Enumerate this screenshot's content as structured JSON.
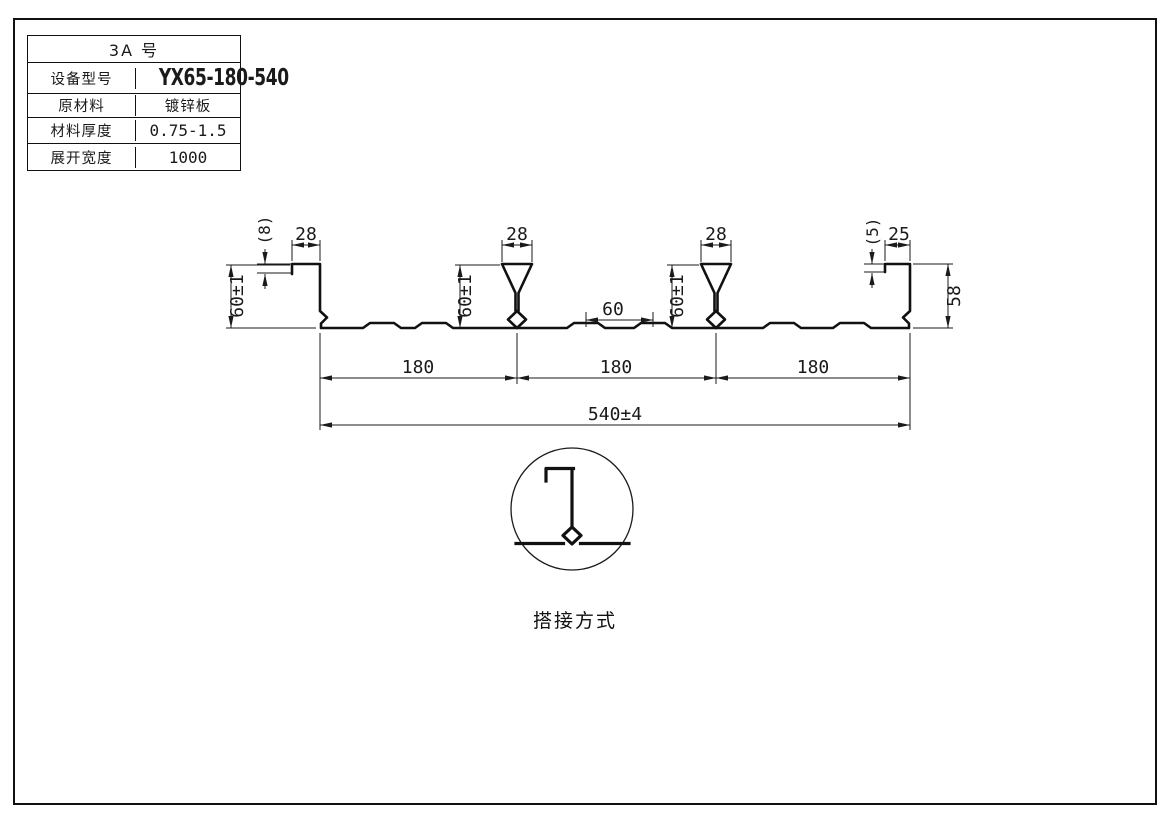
{
  "spec_table": {
    "header": "3A 号",
    "rows": [
      {
        "label": "设备型号",
        "value": "YX65-180-540"
      },
      {
        "label": "原材料",
        "value": "镀锌板"
      },
      {
        "label": "材料厚度",
        "value": "0.75-1.5"
      },
      {
        "label": "展开宽度",
        "value": "1000"
      }
    ]
  },
  "profile_drawing": {
    "dims": {
      "left_lip_height": "(8)",
      "left_hook_width": "28",
      "left_height": "60±1",
      "rib1_top_width": "28",
      "rib1_height": "60±1",
      "stiffener_spacing": "60",
      "rib2_top_width": "28",
      "rib2_height": "60±1",
      "right_lip_height": "(5)",
      "right_hook_width": "25",
      "right_height": "58",
      "pitch_1": "180",
      "pitch_2": "180",
      "pitch_3": "180",
      "overall_width": "540±4"
    }
  },
  "detail": {
    "caption": "搭接方式"
  },
  "colors": {
    "line": "#1a1a1a",
    "background": "#ffffff"
  }
}
